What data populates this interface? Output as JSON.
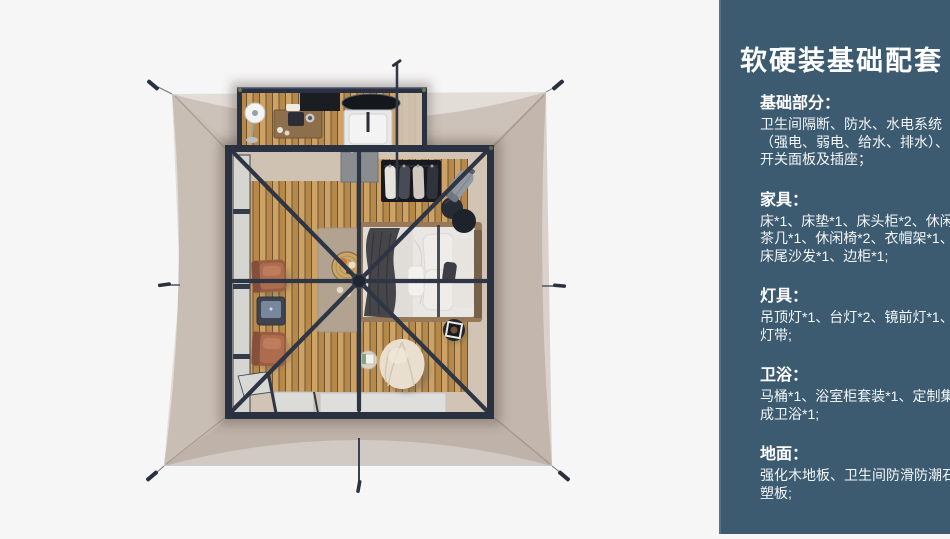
{
  "colors": {
    "page_bg": "#f6f6f6",
    "sidebar_bg": "#3c5a70",
    "sidebar_text": "#ffffff",
    "tent_canvas": "#c6bab1",
    "tent_frame": "#2a3140",
    "wood_floor": "#c1975a"
  },
  "sidebar": {
    "title": "软硬装基础配套",
    "sections": [
      {
        "heading": "基础部分：",
        "body": "卫生间隔断、防水、水电系统\n（强电、弱电、给水、排水）、\n开关面板及插座；"
      },
      {
        "heading": "家具：",
        "body": "床*1、床垫*1、床头柜*2、休闲\n茶几*1、休闲椅*2、衣帽架*1、\n床尾沙发*1、边柜*1;"
      },
      {
        "heading": "灯具：",
        "body": "吊顶灯*1、台灯*2、镜前灯*1、\n灯带;"
      },
      {
        "heading": "卫浴：",
        "body": "马桶*1、浴室柜套装*1、定制集\n成卫浴*1;"
      },
      {
        "heading": "地面：",
        "body": "强化木地板、卫生间防滑防潮石\n塑板;"
      }
    ]
  }
}
